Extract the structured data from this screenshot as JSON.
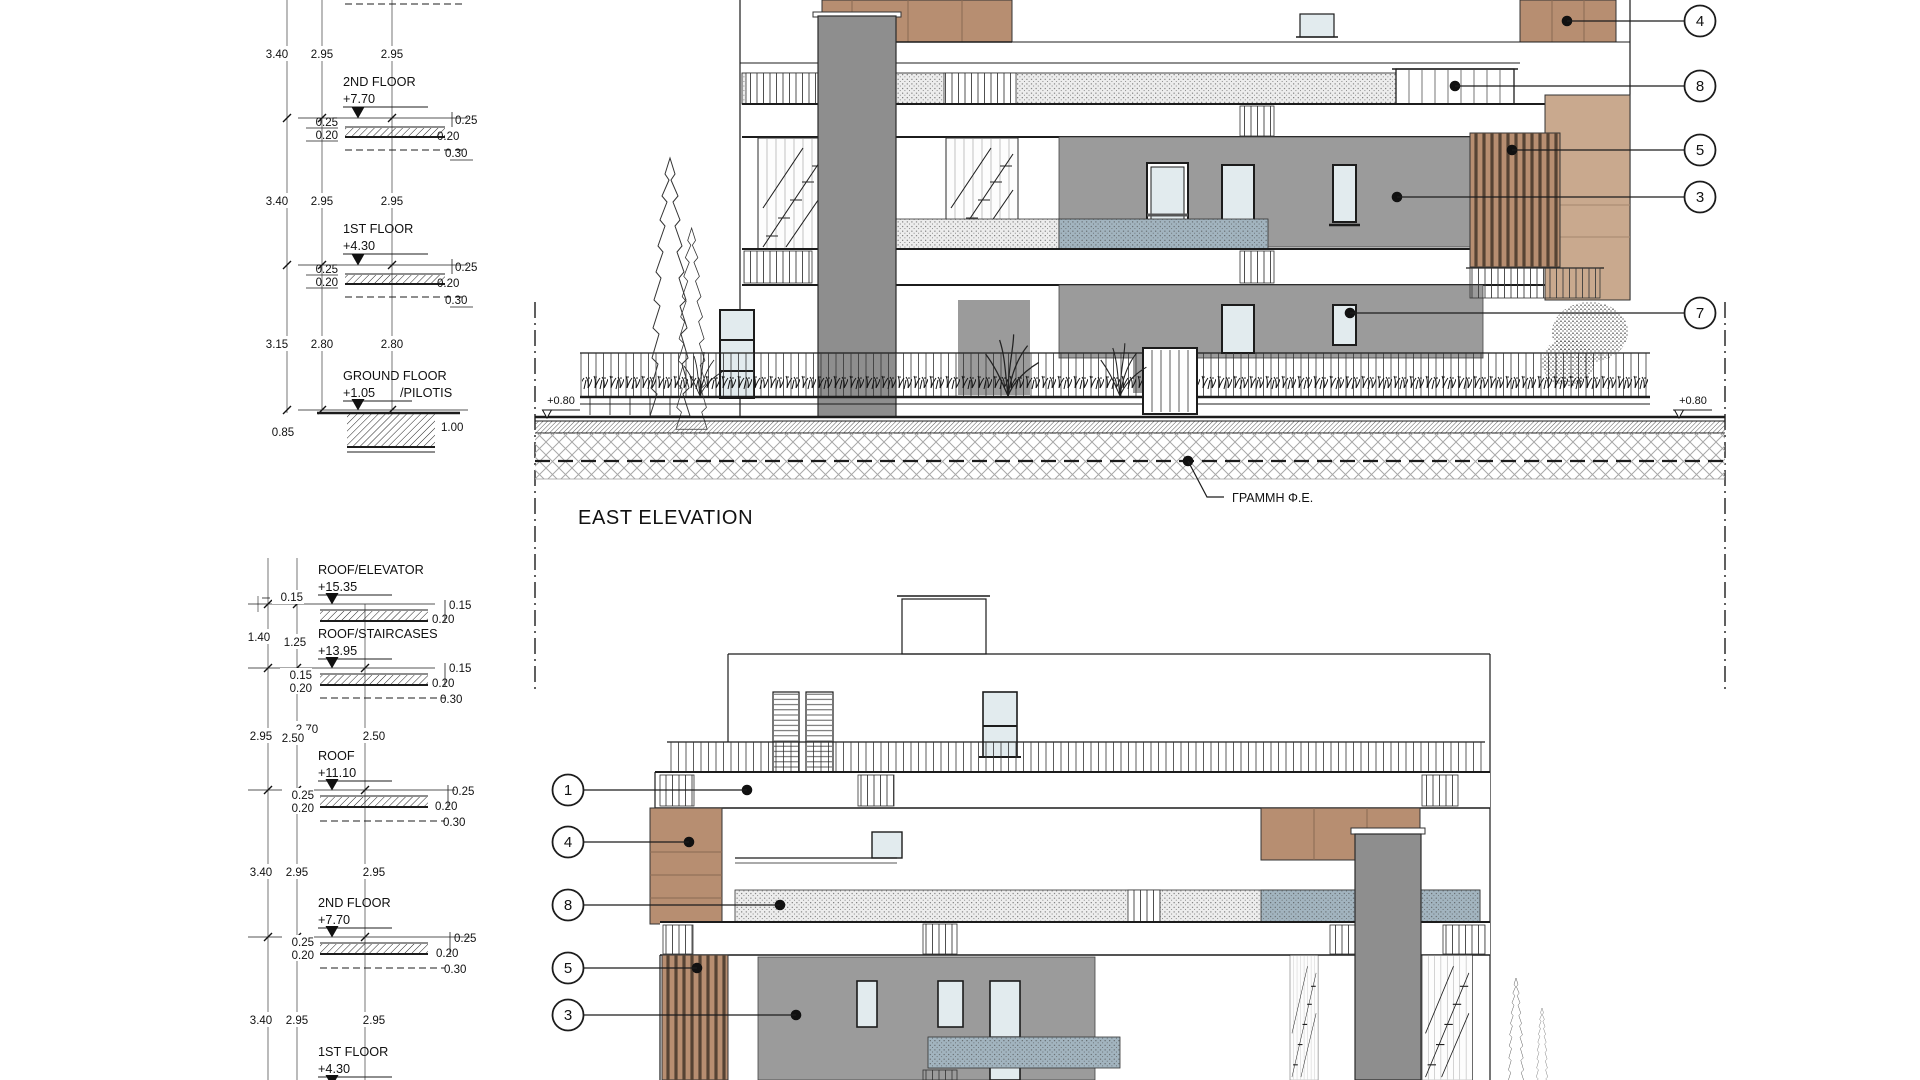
{
  "colors": {
    "wall_gray": "#9b9b9b",
    "column_gray": "#8e8e8e",
    "panel_brown": "#b78e71",
    "panel_tan": "#c9a98e",
    "glass": "#e2ebee",
    "balcony_blue": "#a2b4bf",
    "line": "#1c1c1c"
  },
  "top_stack": {
    "dim_rows": [
      {
        "values": [
          "3.40",
          "2.95",
          "2.95"
        ]
      },
      {
        "values": [
          "3.40",
          "2.95",
          "2.95"
        ]
      },
      {
        "values": [
          "3.15",
          "2.80",
          "2.80"
        ]
      }
    ],
    "floors": [
      {
        "name": "2ND FLOOR",
        "elev": "+7.70",
        "left": [
          "0.25",
          "0.20"
        ],
        "right": [
          "0.25",
          "0.20",
          "0.30"
        ]
      },
      {
        "name": "1ST FLOOR",
        "elev": "+4.30",
        "left": [
          "0.25",
          "0.20"
        ],
        "right": [
          "0.25",
          "0.20",
          "0.30"
        ]
      },
      {
        "name": "GROUND FLOOR",
        "elev": "+1.05",
        "suffix": "/PILOTIS",
        "left": [
          "0.85"
        ],
        "right": [
          "1.00"
        ]
      }
    ]
  },
  "east_elevation": {
    "title": "EAST ELEVATION",
    "level_marker_left": "+0.80",
    "level_marker_right": "+0.80",
    "fe_line_label": "ΓΡΑΜΜΗ Φ.Ε.",
    "callouts": [
      "4",
      "8",
      "5",
      "3",
      "7"
    ]
  },
  "bottom_stack": {
    "dim_rows": [
      {
        "values": [
          "1.40",
          "1.25"
        ]
      },
      {
        "values": [
          "2.95",
          "2.50",
          "2.70",
          "2.50"
        ]
      },
      {
        "values": [
          "3.40",
          "2.95",
          "2.95"
        ]
      },
      {
        "values": [
          "3.40",
          "2.95",
          "2.95"
        ]
      }
    ],
    "floors": [
      {
        "name": "ROOF/ELEVATOR",
        "elev": "+15.35",
        "left": [
          "0.15"
        ],
        "right": [
          "0.15",
          "0.20"
        ]
      },
      {
        "name": "ROOF/STAIRCASES",
        "elev": "+13.95",
        "left": [
          "0.15",
          "0.20"
        ],
        "right": [
          "0.15",
          "0.20",
          "0.30"
        ]
      },
      {
        "name": "ROOF",
        "elev": "+11.10",
        "left": [
          "0.25",
          "0.20"
        ],
        "right": [
          "0.25",
          "0.20",
          "0.30"
        ]
      },
      {
        "name": "2ND FLOOR",
        "elev": "+7.70",
        "left": [
          "0.25",
          "0.20"
        ],
        "right": [
          "0.25",
          "0.20",
          "0.30"
        ]
      },
      {
        "name": "1ST FLOOR",
        "elev": "+4.30"
      }
    ]
  },
  "second_elevation": {
    "callouts": [
      "1",
      "4",
      "8",
      "5",
      "3"
    ]
  }
}
